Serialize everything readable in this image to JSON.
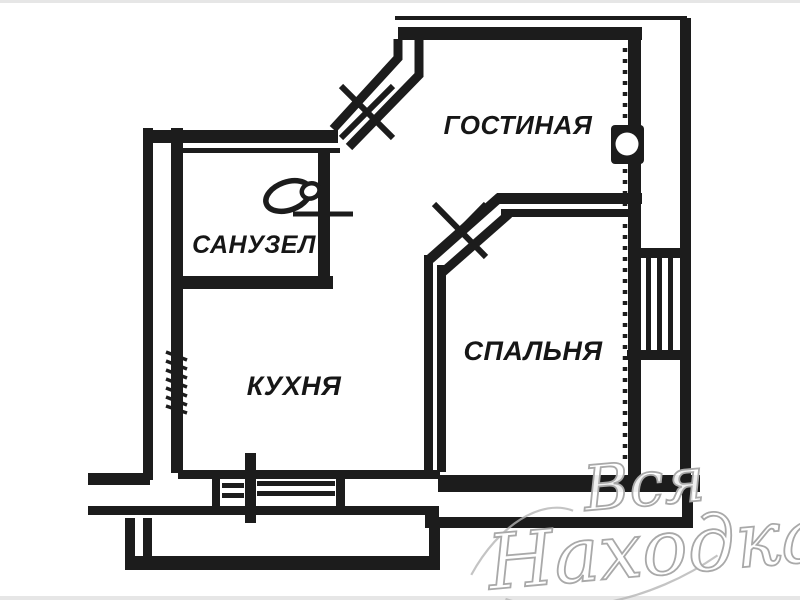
{
  "document": {
    "type": "apartment-floor-plan-scan",
    "language": "Russian"
  },
  "rooms": {
    "living": {
      "label": "ГОСТИНАЯ"
    },
    "bathroom": {
      "label": "САНУЗЕЛ"
    },
    "kitchen": {
      "label": "КУХНЯ"
    },
    "bedroom": {
      "label": "СПАЛЬНЯ"
    }
  },
  "watermark": {
    "word1": "Вся",
    "word2": "Находка"
  },
  "symbols": [
    "door-symbol-living-room",
    "door-symbol-bedroom",
    "door-leaf-bathroom",
    "window-symbol-kitchen",
    "window-bay-symbol-right",
    "toilet-icon",
    "vent-hatch-icon",
    "insulation-dots",
    "wall-niche"
  ],
  "colors": {
    "ink": "#1c1c1c",
    "paper": "#ffffff",
    "watermark_stroke": "#a9a9a9",
    "watermark_fill": "#ffffff",
    "scan_edge": "#dcdcdc"
  }
}
